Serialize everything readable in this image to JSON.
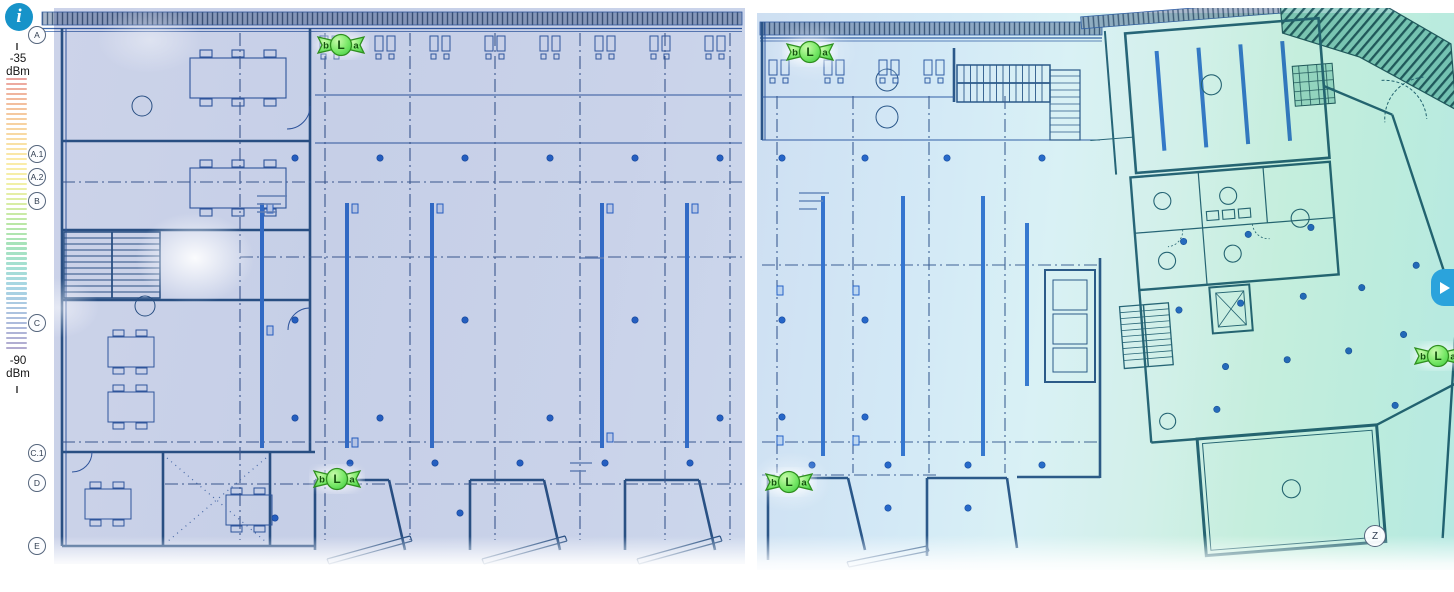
{
  "toolbar": {
    "info_button": {
      "icon": "info",
      "color": "#1793c9"
    },
    "expand_button": {
      "icon": "play-triangle",
      "color": "#2ba3dc"
    }
  },
  "legend": {
    "max_value": "-35",
    "min_value": "-90",
    "unit": "dBm",
    "stripe_count": 55,
    "gradient_stops": [
      "#eca49f",
      "#f2bb9d",
      "#f6cfa0",
      "#f9dfa4",
      "#fbeca9",
      "#f2f0a7",
      "#d9eda5",
      "#b9e7a6",
      "#a6e3bb",
      "#a5e0d2",
      "#a8d6e4",
      "#abc7e2",
      "#aeb8da",
      "#b2abd0"
    ]
  },
  "access_points": [
    {
      "bands": [
        "b",
        "L",
        "a"
      ],
      "x": 341,
      "y": 45
    },
    {
      "bands": [
        "b",
        "L",
        "a"
      ],
      "x": 337,
      "y": 479
    },
    {
      "bands": [
        "b",
        "L",
        "a"
      ],
      "x": 810,
      "y": 52
    },
    {
      "bands": [
        "b",
        "L",
        "a"
      ],
      "x": 789,
      "y": 482
    },
    {
      "bands": [
        "b",
        "L",
        "a"
      ],
      "x": 1438,
      "y": 356
    }
  ],
  "floorplans": [
    {
      "id": "floorplan-left",
      "grid_labels": [
        {
          "label": "A",
          "x": 37,
          "y": 35
        },
        {
          "label": "A.1",
          "x": 37,
          "y": 154
        },
        {
          "label": "A.2",
          "x": 37,
          "y": 177
        },
        {
          "label": "B",
          "x": 37,
          "y": 201
        },
        {
          "label": "C",
          "x": 37,
          "y": 323
        },
        {
          "label": "C.1",
          "x": 37,
          "y": 453
        },
        {
          "label": "D",
          "x": 37,
          "y": 483
        },
        {
          "label": "E",
          "x": 37,
          "y": 546
        }
      ]
    },
    {
      "id": "floorplan-right",
      "grid_labels": [
        {
          "label": "Z",
          "x": 1375,
          "y": 536,
          "size": 22
        }
      ]
    }
  ],
  "heatmap": {
    "weak_color": "#c6cfe7",
    "strong_color": "#b6e9e2"
  }
}
